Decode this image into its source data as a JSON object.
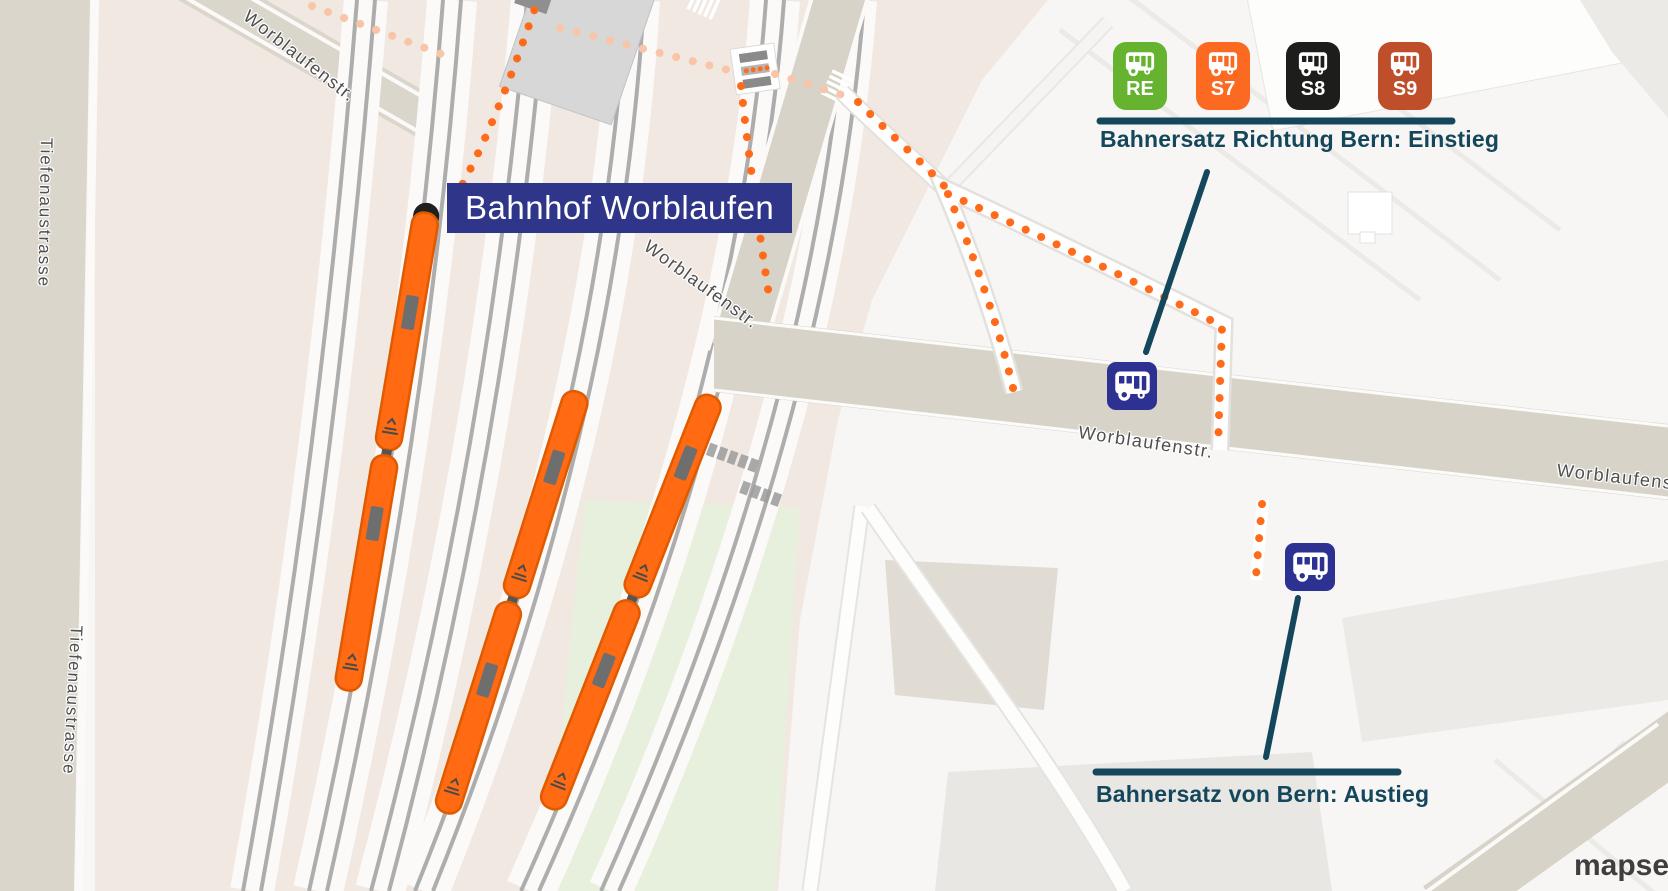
{
  "station": {
    "label": "Bahnhof Worblaufen"
  },
  "streets": {
    "tiefenaustrasse": "Tiefenaustrasse",
    "worblaufenstr": "Worblaufenstr."
  },
  "einstieg": {
    "title": "Bahnersatz Richtung Bern: Einstieg",
    "lines": [
      {
        "id": "RE",
        "color": "#65B32E"
      },
      {
        "id": "S7",
        "color": "#FC6A21"
      },
      {
        "id": "S8",
        "color": "#1D1D1B"
      },
      {
        "id": "S9",
        "color": "#BF4E2B"
      }
    ]
  },
  "ausstieg": {
    "title": "Bahnersatz von Bern: Austieg"
  },
  "icons": {
    "bus_stop": "bus-icon",
    "badge_glyph": "bus-icon",
    "crossing": "rail-crossing-icon"
  },
  "colors": {
    "train": "#FF6A13",
    "route_dots": "#FF6B1A",
    "route_dots_faded": "#F9C5A8",
    "roads": "#D8D3C9",
    "rail_area": "#F2E8E2",
    "rails": "#ADADAD",
    "park": "#E7F0DC",
    "station_label_bg": "#2F3588",
    "annotation": "#15475C",
    "bus_stop_bg": "#2D3192"
  },
  "watermark": {
    "text": "mapset"
  }
}
